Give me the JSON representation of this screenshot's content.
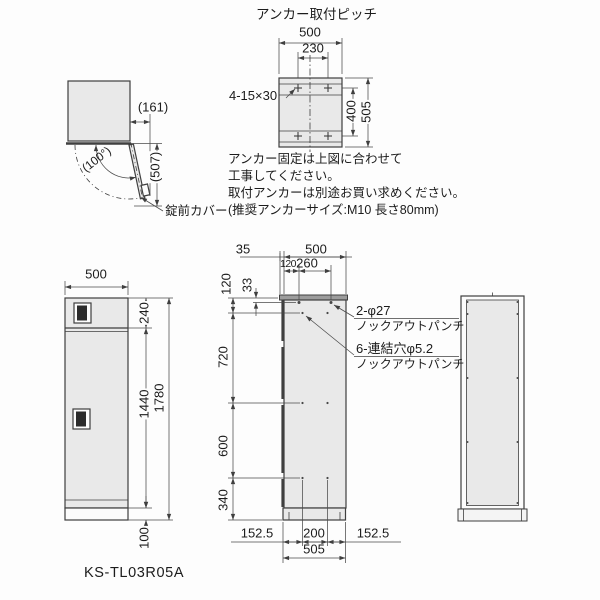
{
  "product": {
    "model": "KS-TL03R05A"
  },
  "anchor_view": {
    "title": "アンカー取付ピッチ",
    "dim_width": "500",
    "dim_pitch_x": "230",
    "dim_pitch_y": "400",
    "dim_depth": "505",
    "slot_label": "4-15×30"
  },
  "top_view": {
    "open_angle": "(100°)",
    "dim_protrusion": "(161)",
    "dim_swing": "(507)",
    "lock_cover_label": "錠前カバー"
  },
  "notes": {
    "line1": "アンカー固定は上図に合わせて",
    "line2": "工事してください。",
    "line3": "取付アンカーは別途お買い求めください。",
    "line4": "(推奨アンカーサイズ:M10 長さ80mm)"
  },
  "front_view": {
    "dim_width": "500",
    "dim_top_section": "240",
    "dim_door": "1440",
    "dim_total_height": "1780",
    "dim_base": "100"
  },
  "side_view": {
    "dim_front": "35",
    "dim_depth": "500",
    "dim_hole_offset1": "120",
    "dim_hole_offset2": "260",
    "dim_row1": "120",
    "dim_top_edge": "33",
    "dim_row_gap1": "720",
    "dim_row_gap2": "600",
    "dim_row_gap3": "340",
    "dim_base_front": "152.5",
    "dim_base_pitch": "200",
    "dim_base_rear": "152.5",
    "dim_base_depth": "505",
    "knockout_label_1a": "2-φ27",
    "knockout_label_1b": "ノックアウトパンチ",
    "knockout_label_2a": "6-連結穴φ5.2",
    "knockout_label_2b": "ノックアウトパンチ"
  }
}
